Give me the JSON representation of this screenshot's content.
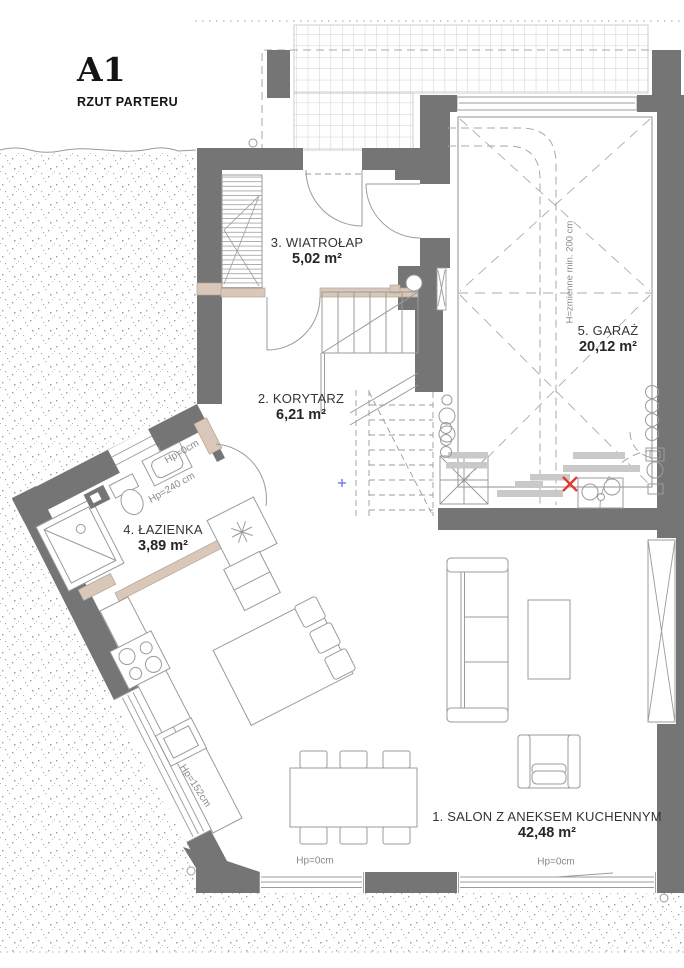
{
  "title": {
    "code": "A1",
    "subtitle": "RZUT PARTERU"
  },
  "rooms": [
    {
      "label": "1. SALON Z ANEKSEM KUCHENNYM",
      "area": "42,48 m²"
    },
    {
      "label": "2. KORYTARZ",
      "area": "6,21 m²"
    },
    {
      "label": "3. WIATROŁAP",
      "area": "5,02 m²"
    },
    {
      "label": "4. ŁAZIENKA",
      "area": "3,89 m²"
    },
    {
      "label": "5. GARAŻ",
      "area": "20,12 m²"
    }
  ],
  "annotations": {
    "salon_window_left": "Hp=0cm",
    "salon_window_right": "Hp=0cm",
    "bath_door": "Hp=0cm",
    "bath_window": "Hp=240 cm",
    "kitchen_window": "Hp=152cm",
    "garage_height": "H=zmienne min. 200 cm"
  },
  "colors": {
    "wall": "#757575",
    "line": "#9b9b9b",
    "lintel_tan": "#d9c8ba",
    "red_marker": "#e23a2e",
    "blue_marker": "#7b7bf0",
    "annotation": "#8a8a8a"
  }
}
